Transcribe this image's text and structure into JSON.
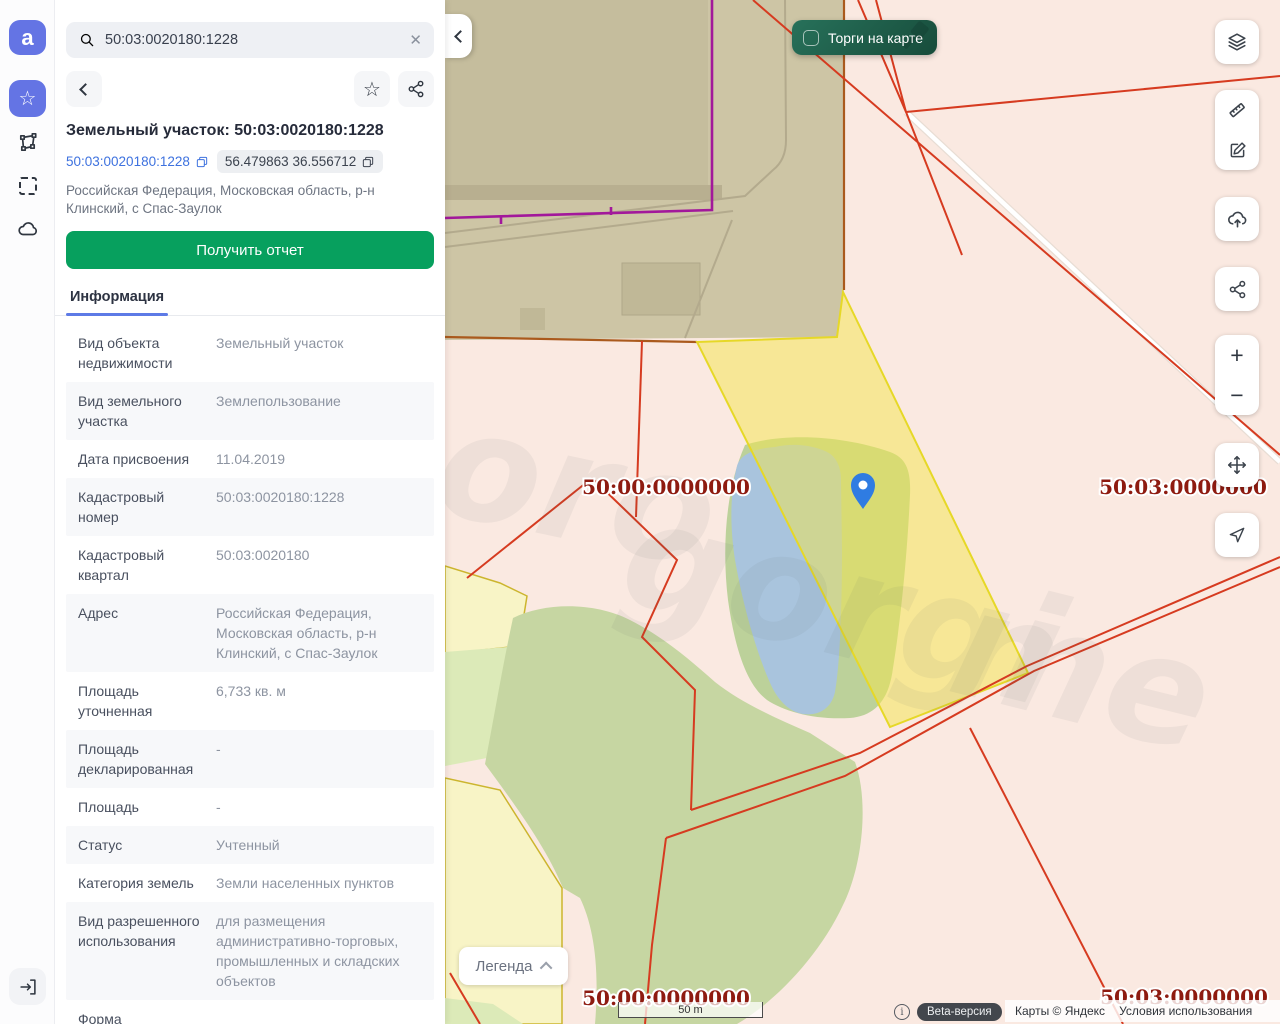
{
  "rail": {
    "logo_glyph": "a",
    "icons": [
      "favorites-star",
      "measure-polygon",
      "area-select",
      "cloud",
      "exit"
    ]
  },
  "sidebar": {
    "search": {
      "value": "50:03:0020180:1228"
    },
    "title": "Земельный участок: 50:03:0020180:1228",
    "chips": {
      "cadastral_number": "50:03:0020180:1228",
      "coordinates": "56.479863 36.556712"
    },
    "address": "Российская Федерация, Московская область, р-н Клинский, с Спас-Заулок",
    "report_button": "Получить отчет",
    "tab": "Информация",
    "info_rows": [
      {
        "label": "Вид объекта недвижимости",
        "value": "Земельный участок"
      },
      {
        "label": "Вид земельного участка",
        "value": "Землепользование"
      },
      {
        "label": "Дата присвоения",
        "value": "11.04.2019"
      },
      {
        "label": "Кадастровый номер",
        "value": "50:03:0020180:1228"
      },
      {
        "label": "Кадастровый квартал",
        "value": "50:03:0020180"
      },
      {
        "label": "Адрес",
        "value": "Российская Федерация, Московская область, р-н Клинский, с Спас-Заулок"
      },
      {
        "label": "Площадь уточненная",
        "value": "6,733 кв. м"
      },
      {
        "label": "Площадь декларированная",
        "value": "-"
      },
      {
        "label": "Площадь",
        "value": "-"
      },
      {
        "label": "Статус",
        "value": "Учтенный"
      },
      {
        "label": "Категория земель",
        "value": "Земли населенных пунктов"
      },
      {
        "label": "Вид разрешенного использования",
        "value": "для размещения административно-торговых, промышленных и складских объектов"
      },
      {
        "label": "Форма",
        "value": ""
      }
    ]
  },
  "map": {
    "trades_toggle_label": "Торги на карте",
    "legend_button": "Легенда",
    "scale_label": "50 m",
    "beta_badge": "Beta-версия",
    "attribution": "Карты © Яндекс",
    "terms_link": "Условия использования",
    "labels": {
      "nw": "50:00:0000000",
      "ne": "50:03:0000000",
      "sw": "50:00:0000000",
      "se": "50:03:0000000"
    },
    "watermark": [
      "oro",
      "gorgi",
      "me"
    ],
    "controls": [
      "layers",
      "ruler",
      "edit",
      "upload",
      "share",
      "zoom-in",
      "zoom-out",
      "move",
      "locate"
    ],
    "colors": {
      "background_pink": "#fae9e1",
      "quarter_beige": "#cdc5a5",
      "boundary_purple": "#a2189b",
      "boundary_red": "#d63b20",
      "selected_parcel_yellow": "#f3e64b",
      "forest_green": "#c6d6a2",
      "pond_blue": "#a9c4dd",
      "pale_parcel": "#f8f4c6",
      "label_dark_red": "#8e1b10",
      "trades_green": "#1d5a46",
      "accent_blue": "#3e72df",
      "report_green": "#07a05e"
    }
  }
}
